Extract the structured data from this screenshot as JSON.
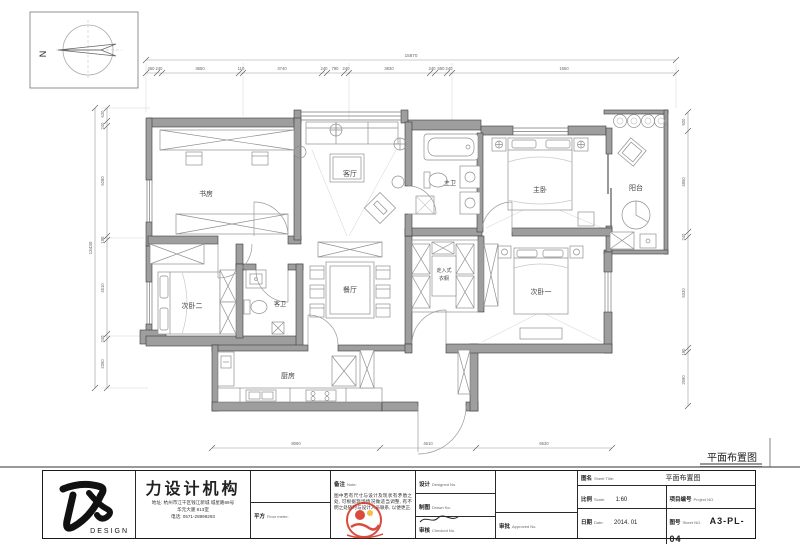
{
  "compass": {
    "north": "N"
  },
  "caption": {
    "plan_title": "平面布置图"
  },
  "rooms": {
    "study": "书房",
    "living": "客厅",
    "dining": "餐厅",
    "kitchen": "厨房",
    "master_bedroom": "主卧",
    "master_bath": "主卫",
    "guest_bath": "客卫",
    "bedroom1": "次卧一",
    "bedroom2": "次卧二",
    "closet_line1": "走入式",
    "closet_line2": "衣橱",
    "balcony": "阳台"
  },
  "dims": {
    "top_total": "15870",
    "top": [
      "450",
      "240",
      "3650",
      "110",
      "3740",
      "240",
      "790",
      "240",
      "3830",
      "240",
      "550",
      "240",
      "1550"
    ],
    "left_total": "13430",
    "left": [
      "620",
      "240",
      "5280",
      "190",
      "4510",
      "240",
      "2350"
    ],
    "right": [
      "920",
      "4850",
      "240",
      "5330",
      "190",
      "2590"
    ],
    "bottom": [
      "8060",
      "4610",
      "6530"
    ]
  },
  "titleblock": {
    "logo_word": "DESIGN",
    "company": "力设计机构",
    "address1": "地址: 杭州市江干区钱江新城 城星路89号",
    "address2": "华元大厦 813室",
    "phone": "电话: 0571-28999293",
    "floor_metre": {
      "zh": "平方",
      "en": "Floor metre:"
    },
    "note": {
      "zh": "备注",
      "en": "Note:",
      "text": "图中若有尺寸与设计及现状有矛盾之处, 可根据现场情况做适当调整, 有不明之处随时与设计人员联系, 以便更正."
    },
    "designed": {
      "zh": "设计",
      "en": "Designed No."
    },
    "drawn": {
      "zh": "制图",
      "en": "Drawn No."
    },
    "checked": {
      "zh": "审核",
      "en": "Checked No."
    },
    "approved": {
      "zh": "审批",
      "en": "Approved No."
    },
    "sheet_title": {
      "zh": "图名",
      "en": "Sheet Title:",
      "value": "平面布置图"
    },
    "scale": {
      "zh": "比例",
      "en": "Scale:",
      "value": "1:60"
    },
    "project_no": {
      "zh": "项目编号",
      "en": "Project NO."
    },
    "date": {
      "zh": "日期",
      "en": "Date:",
      "value": "2014. 01"
    },
    "sheet_no": {
      "zh": "图号",
      "en": "Sheet NO.",
      "value": "A3-PL-04"
    }
  }
}
